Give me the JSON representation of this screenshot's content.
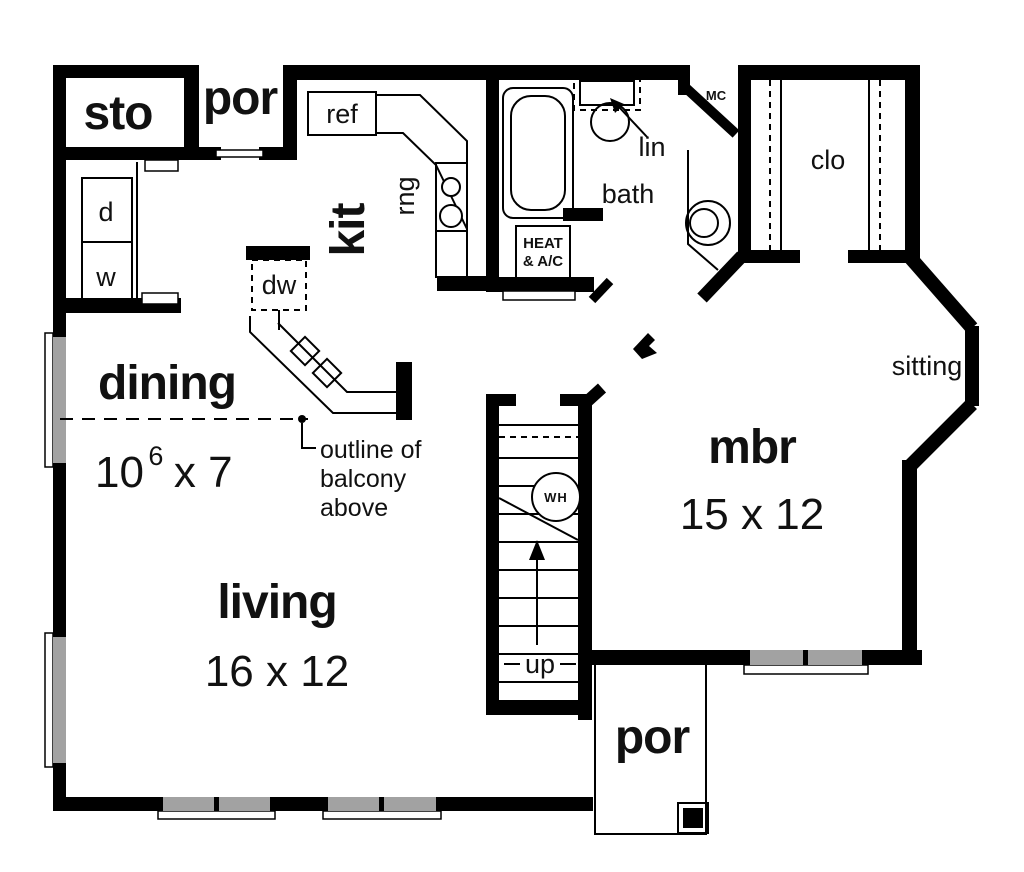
{
  "title": "first floor plan",
  "colors": {
    "bg": "#ffffff",
    "wall": "#000000",
    "ink": "#111111",
    "win": "#b9b9b9",
    "winline": "#8a8a8a"
  },
  "rooms": {
    "sto": "sto",
    "por_top": "por",
    "kit": "kit",
    "dining": "dining",
    "living": "living",
    "mbr": "mbr",
    "sitting": "sitting",
    "bath": "bath",
    "clo": "clo",
    "por_bottom": "por"
  },
  "dimensions": {
    "dining_base": "10",
    "dining_sup": "6",
    "dining_rest": "x 7",
    "living": "16 x 12",
    "mbr": "15 x 12"
  },
  "fixtures": {
    "ref": "ref",
    "rng": "rng",
    "dw": "dw",
    "dryer": "d",
    "washer": "w",
    "water_heater": "WH",
    "heat_line1": "HEAT",
    "heat_line2": "& A/C",
    "lin": "lin",
    "mc": "MC",
    "up": "up"
  },
  "annotations": {
    "balcony_line1": "outline of",
    "balcony_line2": "balcony",
    "balcony_line3": "above"
  }
}
